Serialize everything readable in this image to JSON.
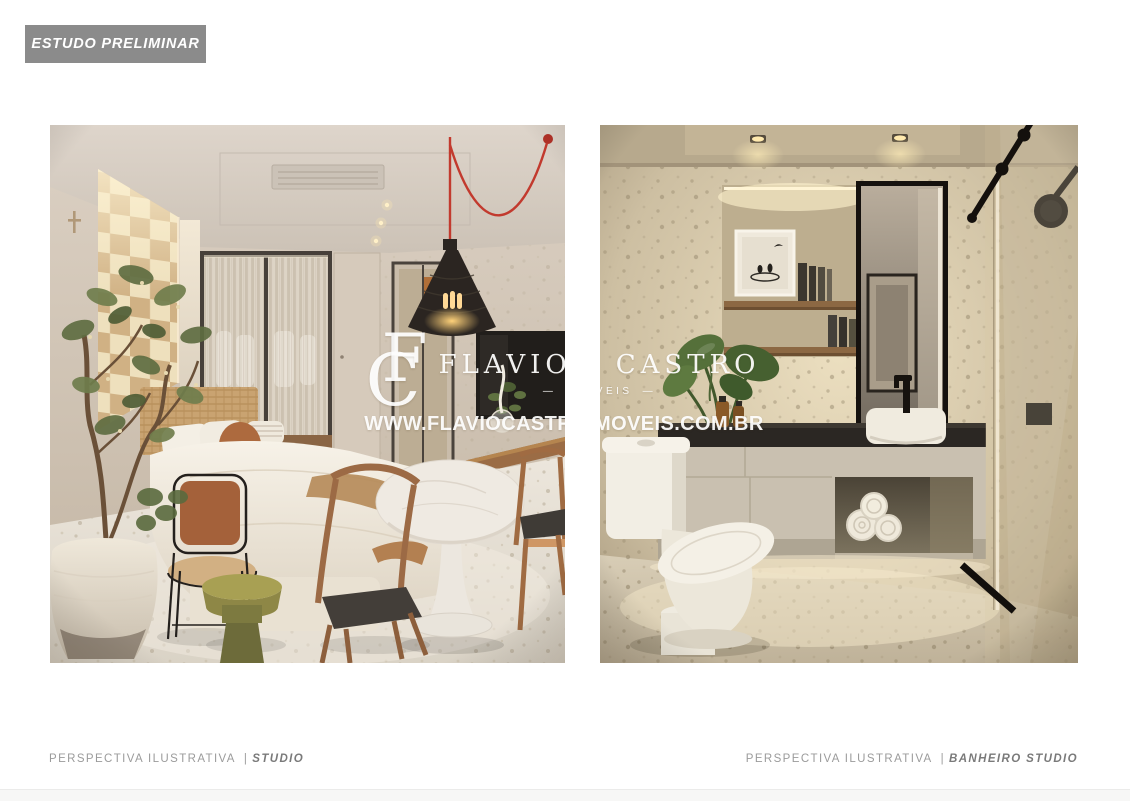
{
  "page": {
    "badge_label": "ESTUDO PRELIMINAR"
  },
  "watermark": {
    "monogram_c": "C",
    "monogram_f": "F",
    "brand_first": "FLAVIO",
    "brand_second": "CASTRO",
    "subtitle_dash": "—",
    "subtitle": "IMÓVEIS",
    "url": "WWW.FLAVIOCASTROIMOVEIS.COM.BR"
  },
  "captions": {
    "left": {
      "prefix": "PERSPECTIVA ILUSTRATIVA",
      "separator": "|",
      "label": "STUDIO"
    },
    "right": {
      "prefix": "PERSPECTIVA ILUSTRATIVA",
      "separator": "|",
      "label": "BANHEIRO STUDIO"
    }
  },
  "colors": {
    "badge_bg": "#8b8b8b",
    "badge_text": "#ffffff",
    "caption_text": "#9b9b9b",
    "caption_emphasis": "#7a7a7a",
    "watermark_text": "#ffffff",
    "page_bg": "#ffffff"
  }
}
